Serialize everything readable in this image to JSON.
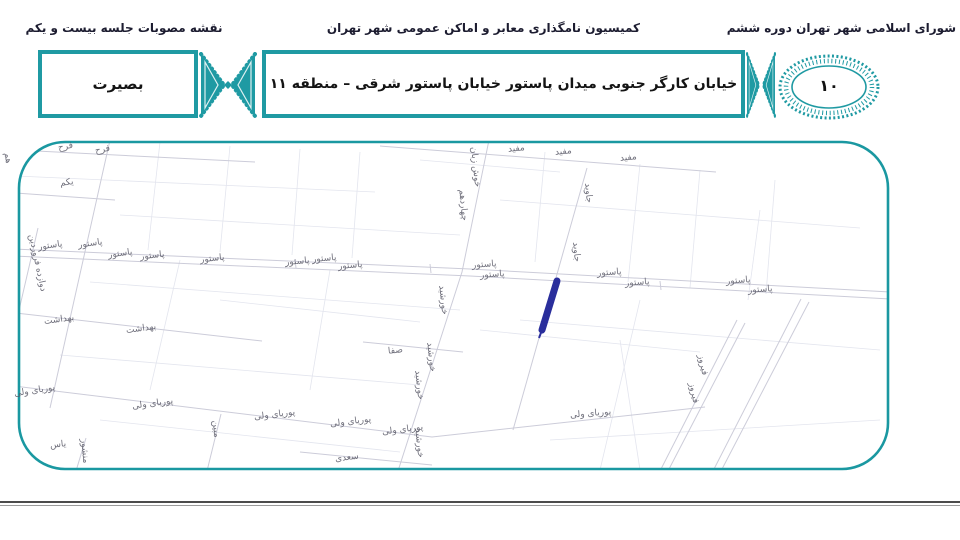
{
  "header": {
    "right": "شورای اسلامی شهر تهران دوره ششم",
    "center": "کمیسیون نامگذاری معابر و اماکن عمومی شهر تهران",
    "left": "نقشه مصوبات جلسه بیست و یکم"
  },
  "banner": {
    "title": "خیابان کارگر جنوبی میدان پاستور خیابان پاستور شرقی  –  منطقه ۱۱",
    "name_box": "بصیرت",
    "badge_number": "۱۰"
  },
  "colors": {
    "accent_teal": "#1f9aa3",
    "highlight_blue": "#2a2e9c",
    "street_line": "#ccccd9",
    "parcel_line": "#e3e5ee",
    "label_text": "#565664"
  },
  "map": {
    "highlight": "blue marker stroke on unnamed alley south of Pasteur street",
    "labels": [
      {
        "text": "فرح",
        "x": 58,
        "y": 142,
        "r": -10
      },
      {
        "text": "فرح",
        "x": 95,
        "y": 145,
        "r": -10
      },
      {
        "text": "هم",
        "x": 2,
        "y": 153,
        "r": 80
      },
      {
        "text": "یکم",
        "x": 60,
        "y": 178,
        "r": -8
      },
      {
        "text": "مفید",
        "x": 508,
        "y": 144,
        "r": -6
      },
      {
        "text": "مفید",
        "x": 555,
        "y": 147,
        "r": -6
      },
      {
        "text": "مفید",
        "x": 620,
        "y": 153,
        "r": -6
      },
      {
        "text": "خوش زبان",
        "x": 455,
        "y": 162,
        "r": 84
      },
      {
        "text": "چهاردهم",
        "x": 447,
        "y": 200,
        "r": 85
      },
      {
        "text": "جاوید",
        "x": 578,
        "y": 188,
        "r": 85
      },
      {
        "text": "جاوید",
        "x": 566,
        "y": 247,
        "r": 85
      },
      {
        "text": "پاستور",
        "x": 38,
        "y": 241,
        "r": -8
      },
      {
        "text": "پاستور",
        "x": 78,
        "y": 239,
        "r": -8
      },
      {
        "text": "پاستور",
        "x": 108,
        "y": 249,
        "r": -8
      },
      {
        "text": "پاستور",
        "x": 140,
        "y": 251,
        "r": -6
      },
      {
        "text": "پاستور",
        "x": 200,
        "y": 254,
        "r": -6
      },
      {
        "text": "پاستور",
        "x": 285,
        "y": 257,
        "r": -5
      },
      {
        "text": "پاستور",
        "x": 312,
        "y": 254,
        "r": -5
      },
      {
        "text": "پاستور",
        "x": 338,
        "y": 261,
        "r": -5
      },
      {
        "text": "پاستور",
        "x": 472,
        "y": 260,
        "r": -4
      },
      {
        "text": "پاستور",
        "x": 480,
        "y": 270,
        "r": -4
      },
      {
        "text": "پاستور",
        "x": 597,
        "y": 268,
        "r": -4
      },
      {
        "text": "پاستور",
        "x": 625,
        "y": 278,
        "r": -4
      },
      {
        "text": "پاستور",
        "x": 726,
        "y": 276,
        "r": -4
      },
      {
        "text": "پاستور",
        "x": 748,
        "y": 285,
        "r": -4
      },
      {
        "text": "دوازده فروردین",
        "x": 8,
        "y": 258,
        "r": 78
      },
      {
        "text": "بهداشت",
        "x": 44,
        "y": 315,
        "r": -8
      },
      {
        "text": "بهداشت",
        "x": 126,
        "y": 324,
        "r": -8
      },
      {
        "text": "خورشید",
        "x": 428,
        "y": 295,
        "r": 84
      },
      {
        "text": "صفا",
        "x": 388,
        "y": 346,
        "r": -6
      },
      {
        "text": "خورشید",
        "x": 416,
        "y": 352,
        "r": 84
      },
      {
        "text": "خورشید",
        "x": 404,
        "y": 380,
        "r": 84
      },
      {
        "text": "خورشید",
        "x": 404,
        "y": 438,
        "r": 84
      },
      {
        "text": "پوریای ولی",
        "x": 14,
        "y": 386,
        "r": -9
      },
      {
        "text": "پوریای ولی",
        "x": 132,
        "y": 399,
        "r": -8
      },
      {
        "text": "پوریای ولی",
        "x": 254,
        "y": 410,
        "r": -7
      },
      {
        "text": "پوریای ولی",
        "x": 330,
        "y": 417,
        "r": -7
      },
      {
        "text": "پوریای ولی",
        "x": 382,
        "y": 425,
        "r": -7
      },
      {
        "text": "پوریای ولی",
        "x": 570,
        "y": 409,
        "r": -5
      },
      {
        "text": "مبین",
        "x": 207,
        "y": 424,
        "r": 85
      },
      {
        "text": "یاس",
        "x": 50,
        "y": 440,
        "r": -6
      },
      {
        "text": "منشور",
        "x": 72,
        "y": 446,
        "r": 85
      },
      {
        "text": "سعدی",
        "x": 335,
        "y": 453,
        "r": -7
      },
      {
        "text": "فیروز",
        "x": 692,
        "y": 360,
        "r": 78
      },
      {
        "text": "فیروز",
        "x": 683,
        "y": 388,
        "r": 78
      }
    ]
  }
}
